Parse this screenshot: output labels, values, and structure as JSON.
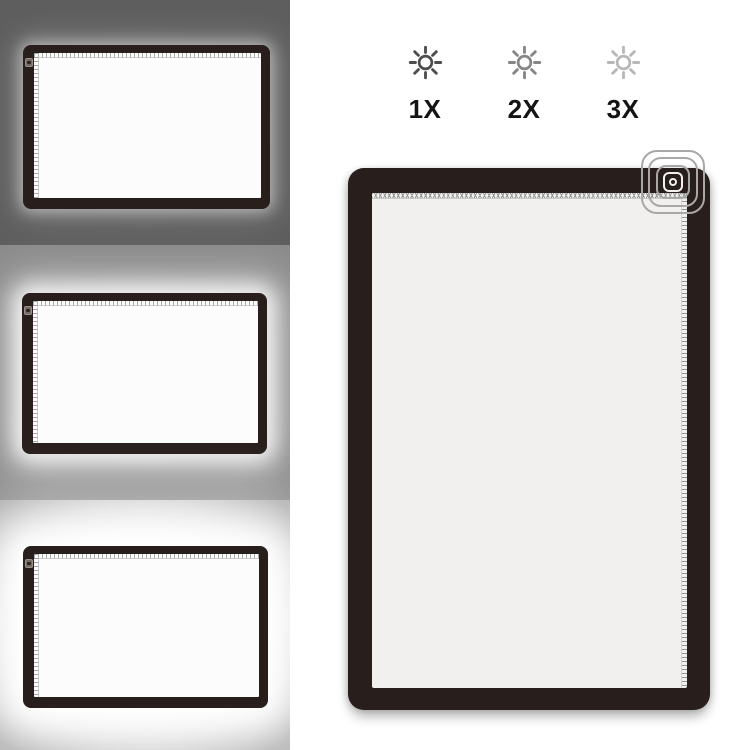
{
  "brightness_selector": {
    "levels": [
      {
        "label": "1X",
        "icon": "sun-brightness-icon",
        "icon_color": "#4d4d4d"
      },
      {
        "label": "2X",
        "icon": "sun-brightness-icon",
        "icon_color": "#868686"
      },
      {
        "label": "3X",
        "icon": "sun-brightness-icon",
        "icon_color": "#b7b7b7"
      }
    ]
  },
  "previews": [
    {
      "name": "brightness-preview-1x",
      "background": "#5e5e5e",
      "glow": "low"
    },
    {
      "name": "brightness-preview-2x",
      "background": "#8a8a8a",
      "glow": "medium"
    },
    {
      "name": "brightness-preview-3x",
      "background": "#aeaeae",
      "glow": "high"
    }
  ],
  "light_pad": {
    "frame_color": "#281e1b",
    "screen_color": "#f1f0ee",
    "small_screen_color": "#fcfcfc",
    "ruler_tick_color": "#949494",
    "ring_color": "#a8a8a8",
    "power_button_icon": "power-touch-button-icon",
    "tap_indicator_icon": "tap-ripple-rings-icon"
  }
}
